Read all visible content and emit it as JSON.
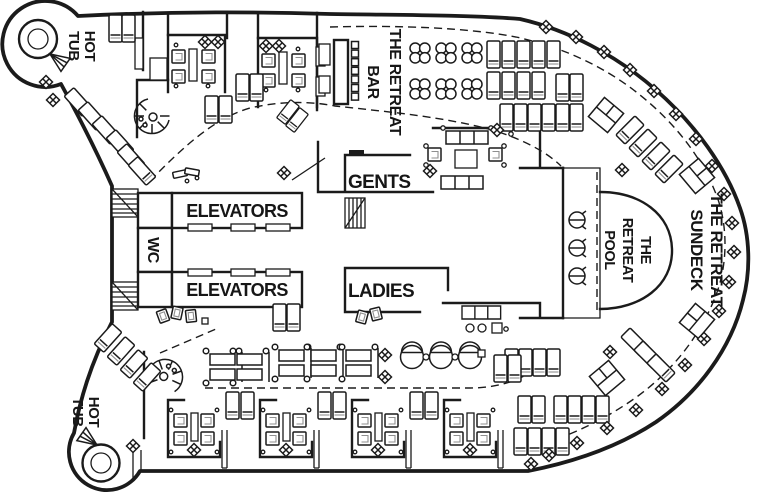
{
  "deck_plan": {
    "labels": {
      "hot_tub_top": {
        "line1": "HOT",
        "line2": "TUB"
      },
      "hot_tub_bottom": {
        "line1": "HOT",
        "line2": "TUB"
      },
      "retreat_bar": {
        "line1": "THE RETREAT",
        "line2": "BAR"
      },
      "gents": "GENTS",
      "ladies": "LADIES",
      "elevators_top": "ELEVATORS",
      "elevators_bottom": "ELEVATORS",
      "wc": "WC",
      "retreat_pool": {
        "line1": "THE",
        "line2": "RETREAT",
        "line3": "POOL"
      },
      "retreat_sundeck": {
        "line1": "THE RETREAT",
        "line2": "SUNDECK"
      }
    },
    "colors": {
      "ink": "#1b1b1b",
      "accent_gray": "#8f8f8f",
      "background": "#ffffff"
    }
  }
}
